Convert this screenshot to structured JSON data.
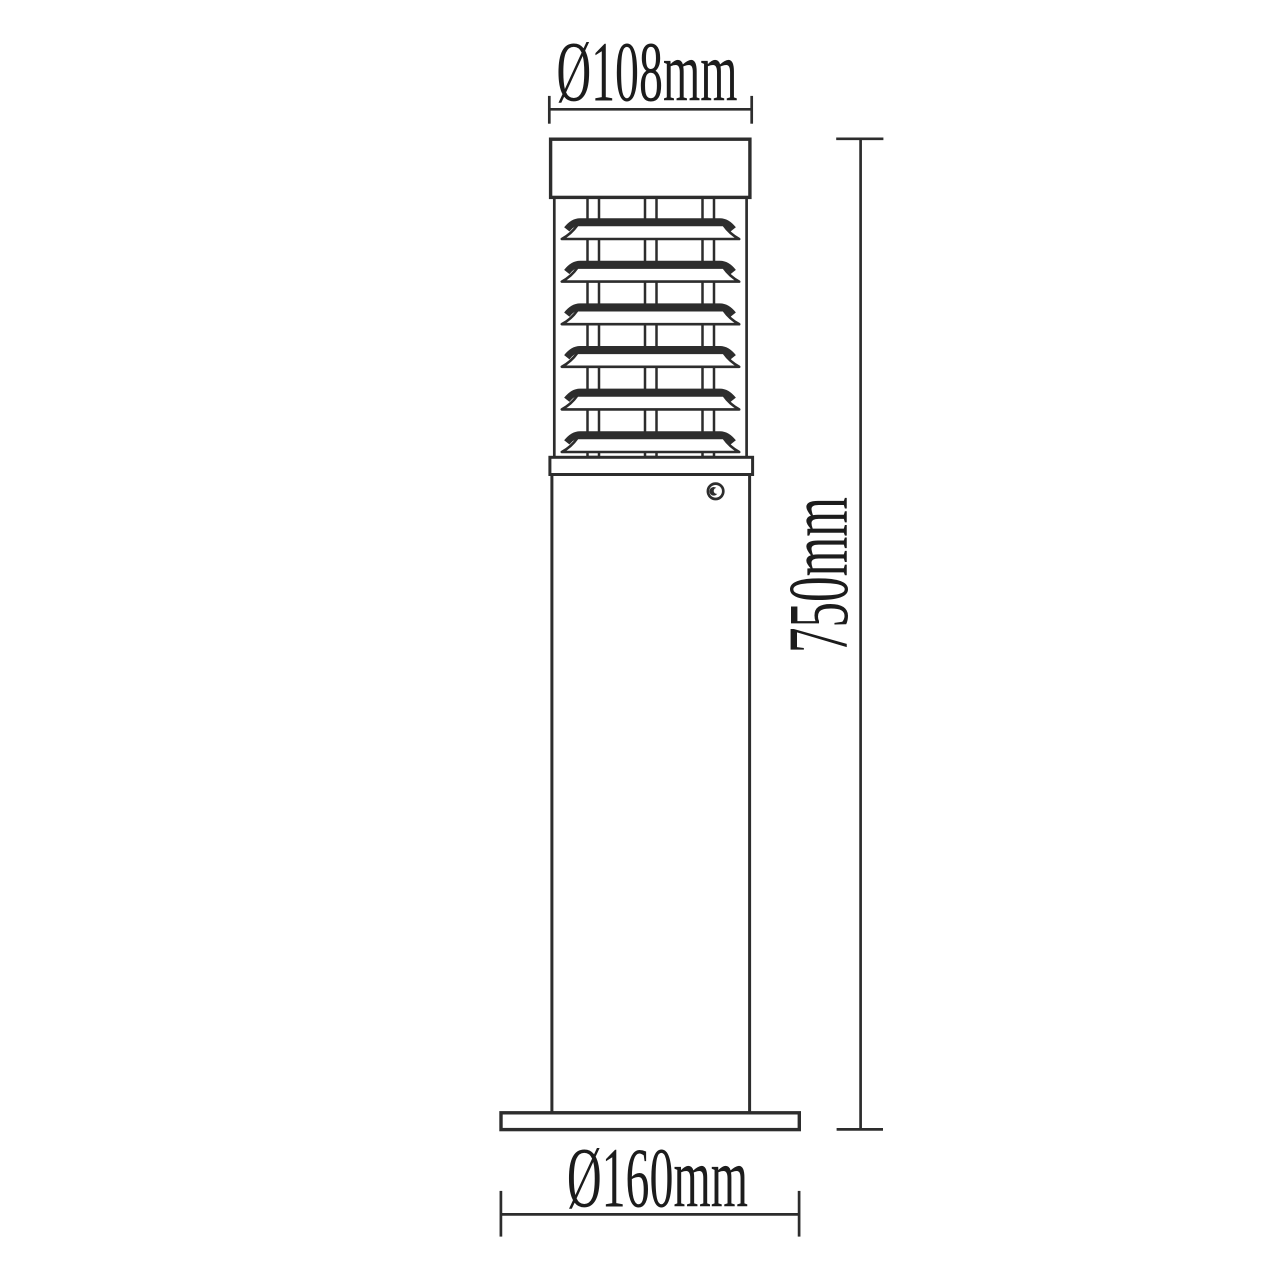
{
  "drawing": {
    "title": "bollard-light-elevation-drawing",
    "background": "#ffffff",
    "line_color": "#2d2d2d",
    "text_color": "#1c1c1c",
    "louver_count": 6,
    "labels": {
      "top_diameter": "Ø108mm",
      "overall_height": "750mm",
      "base_diameter": "Ø160mm"
    }
  }
}
